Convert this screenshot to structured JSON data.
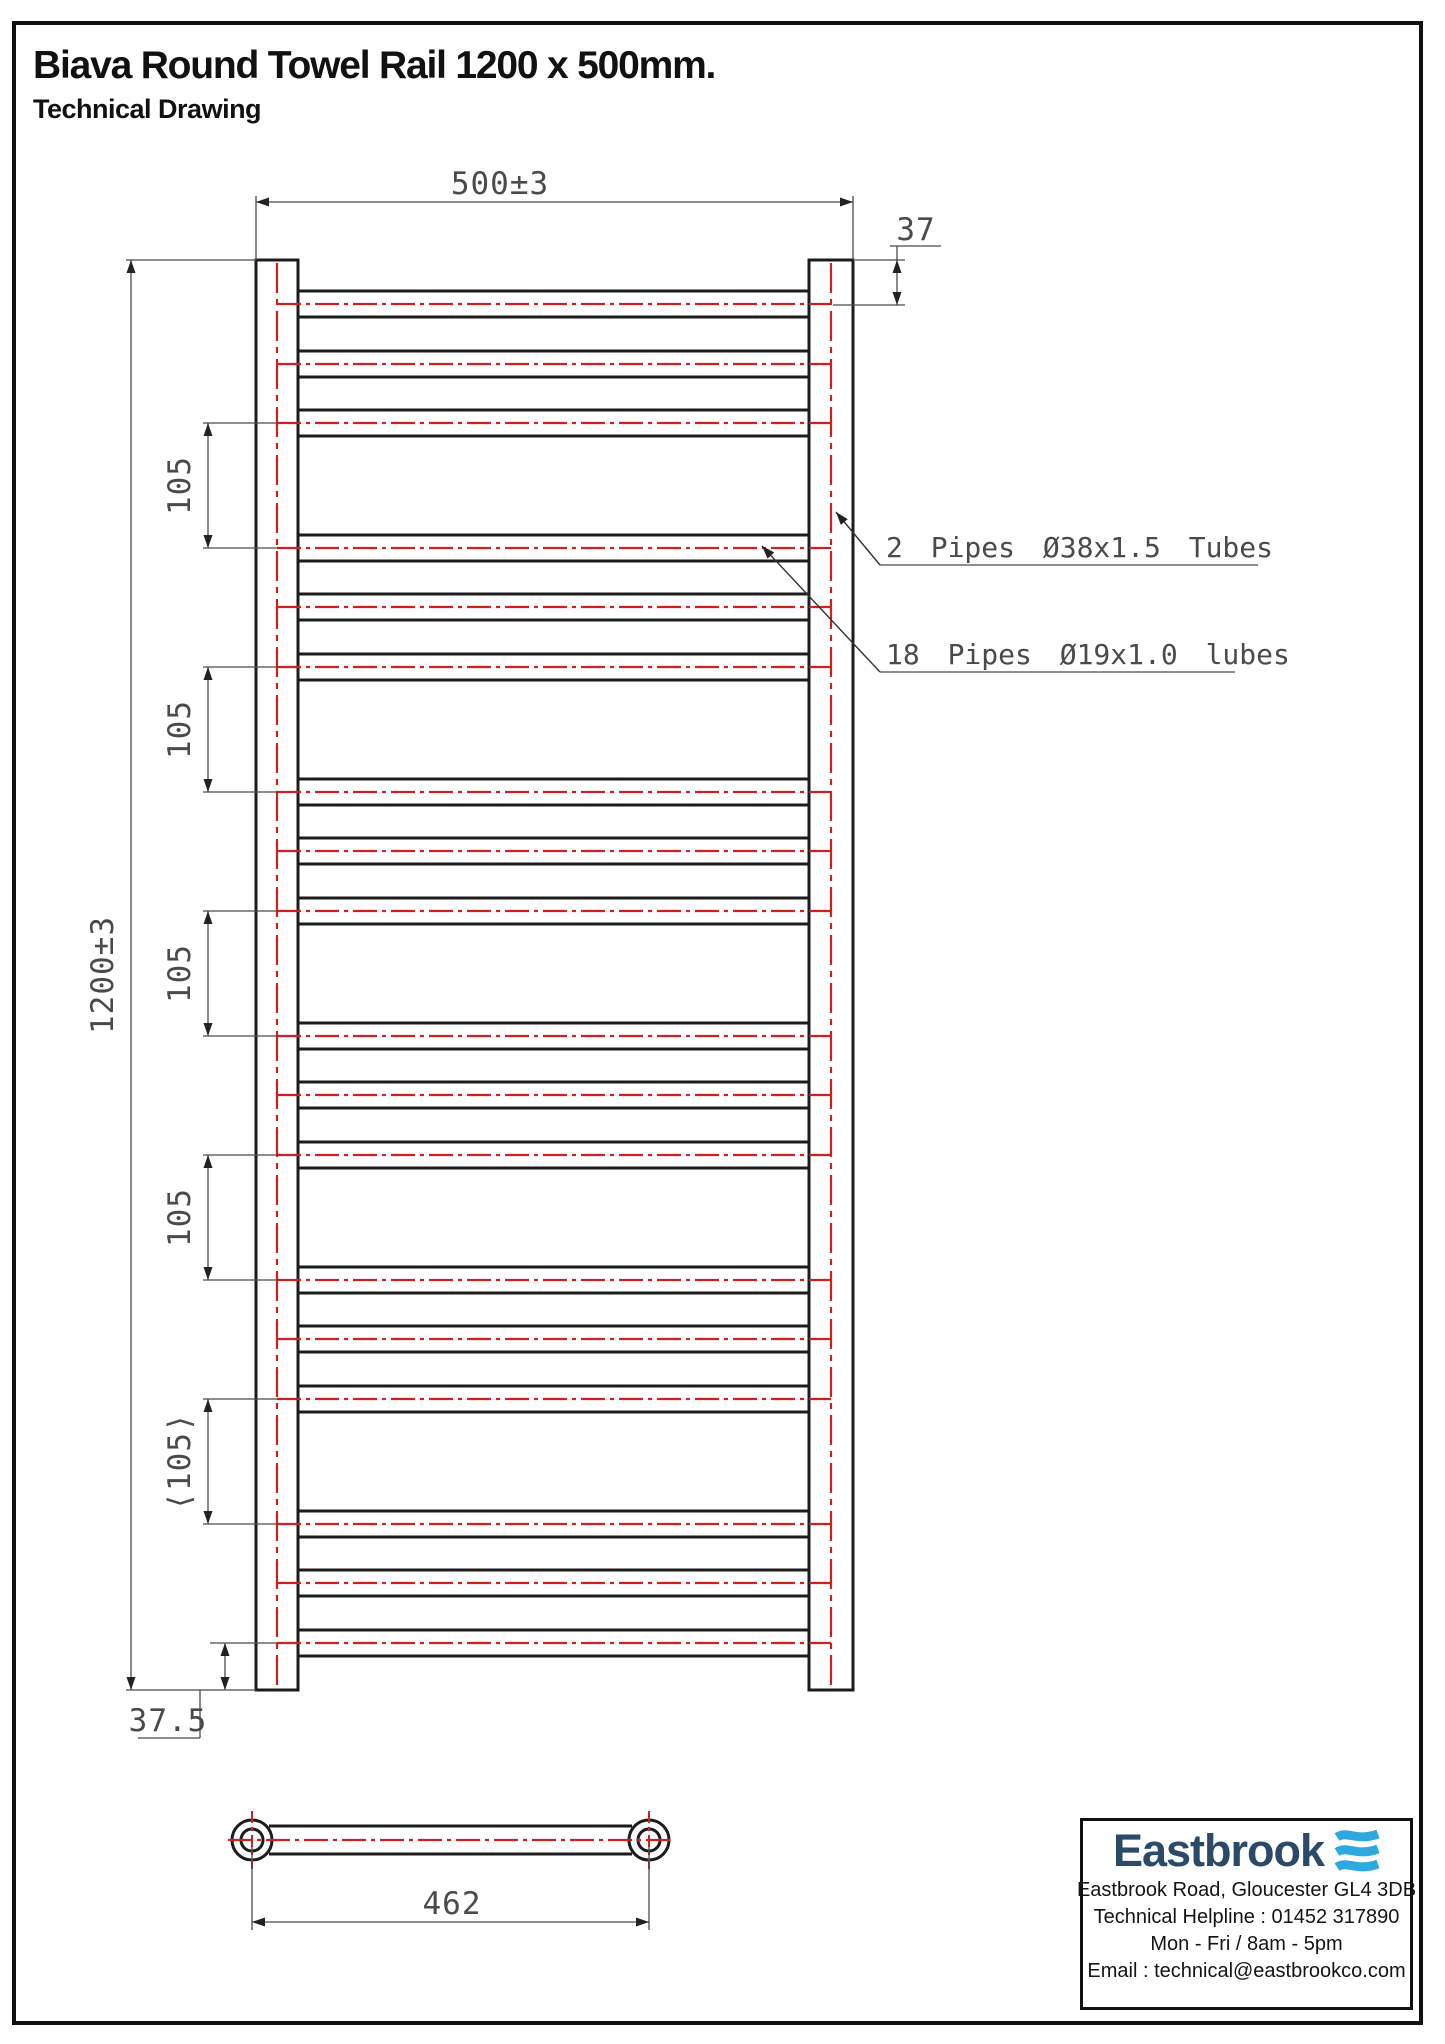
{
  "page": {
    "title": "Biava Round Towel Rail 1200 x 500mm.",
    "subtitle": "Technical Drawing"
  },
  "colors": {
    "ink": "#1c1c1c",
    "dim_line": "#4a4a4a",
    "arrow": "#222222",
    "red": "#cf2020",
    "navy": "#2b4a68",
    "wave_blue": "#2da9e0"
  },
  "front_view": {
    "tube_top": 260,
    "tube_bottom": 1690,
    "left_tube": {
      "x": 256,
      "w": 42
    },
    "right_tube": {
      "x": 809,
      "w": 44
    },
    "rung_x1": 298,
    "rung_x2": 809,
    "rung_half": 13,
    "center_left": 277,
    "center_right": 831,
    "rungs_y": [
      304,
      364,
      423,
      548,
      607,
      667,
      792,
      851,
      911,
      1036,
      1095,
      1155,
      1280,
      1339,
      1399,
      1524,
      1583,
      1643
    ]
  },
  "dimensions": {
    "width": {
      "label": "500±3",
      "y": 202,
      "x1": 256,
      "x2": 853,
      "tx": 500,
      "ty": 194
    },
    "height": {
      "label": "1200±3",
      "x": 131,
      "y1": 260,
      "y2": 1690,
      "ext_x1": 126,
      "ext_x2": 256,
      "tx": 113,
      "ty": 975
    },
    "top_offset": {
      "label": "37",
      "x": 897,
      "y1": 260,
      "y2": 305,
      "ext1_x1": 855,
      "ext2_x1": 833,
      "ext_x2": 905,
      "tx": 916,
      "ty": 240,
      "ul_x1": 890,
      "ul_x2": 941,
      "ul_y": 246
    },
    "bottom_offset": {
      "label": "37.5",
      "x": 225,
      "y1": 1643,
      "y2": 1690,
      "ext_x1": 210,
      "ext_x2": 278,
      "tx": 168,
      "ty": 1731,
      "ul_x1": 138,
      "ul_x2": 200,
      "ul_y": 1738
    },
    "pitch": {
      "label": "105",
      "label_last": "⟨105⟩",
      "x": 208,
      "ext_x1": 203,
      "ext_x2": 278,
      "tx": 190,
      "spans": [
        [
          423,
          548
        ],
        [
          667,
          792
        ],
        [
          911,
          1036
        ],
        [
          1155,
          1280
        ],
        [
          1399,
          1524
        ]
      ]
    },
    "bracket_centers": {
      "label": "462",
      "y": 1922,
      "x1": 252,
      "x2": 649,
      "tx": 452,
      "ty": 1914
    }
  },
  "annotations": [
    {
      "label": "2 Pipes Ø38x1.5 Tubes",
      "tx": 886,
      "ty": 557,
      "ux1": 880,
      "ux2": 1258,
      "uy": 565,
      "tipx": 836,
      "tipy": 512
    },
    {
      "label": "18 Pipes Ø19x1.0 lubes",
      "tx": 886,
      "ty": 664,
      "ux1": 880,
      "ux2": 1235,
      "uy": 672,
      "tipx": 762,
      "tipy": 546
    }
  ],
  "bottom_view": {
    "cy": 1840,
    "cx1": 252,
    "cx2": 649,
    "r_outer": 20,
    "r_inner": 11,
    "bar_half": 14,
    "red_x1": 228,
    "red_x2": 672,
    "red_vhalf": 29,
    "ext_y2": 1930
  },
  "eastbrook": {
    "logo": "Eastbrook",
    "lines": [
      "Eastbrook Road, Gloucester GL4 3DB",
      "Technical Helpline : 01452 317890",
      "Mon - Fri / 8am - 5pm",
      "Email : technical@eastbrookco.com"
    ]
  }
}
